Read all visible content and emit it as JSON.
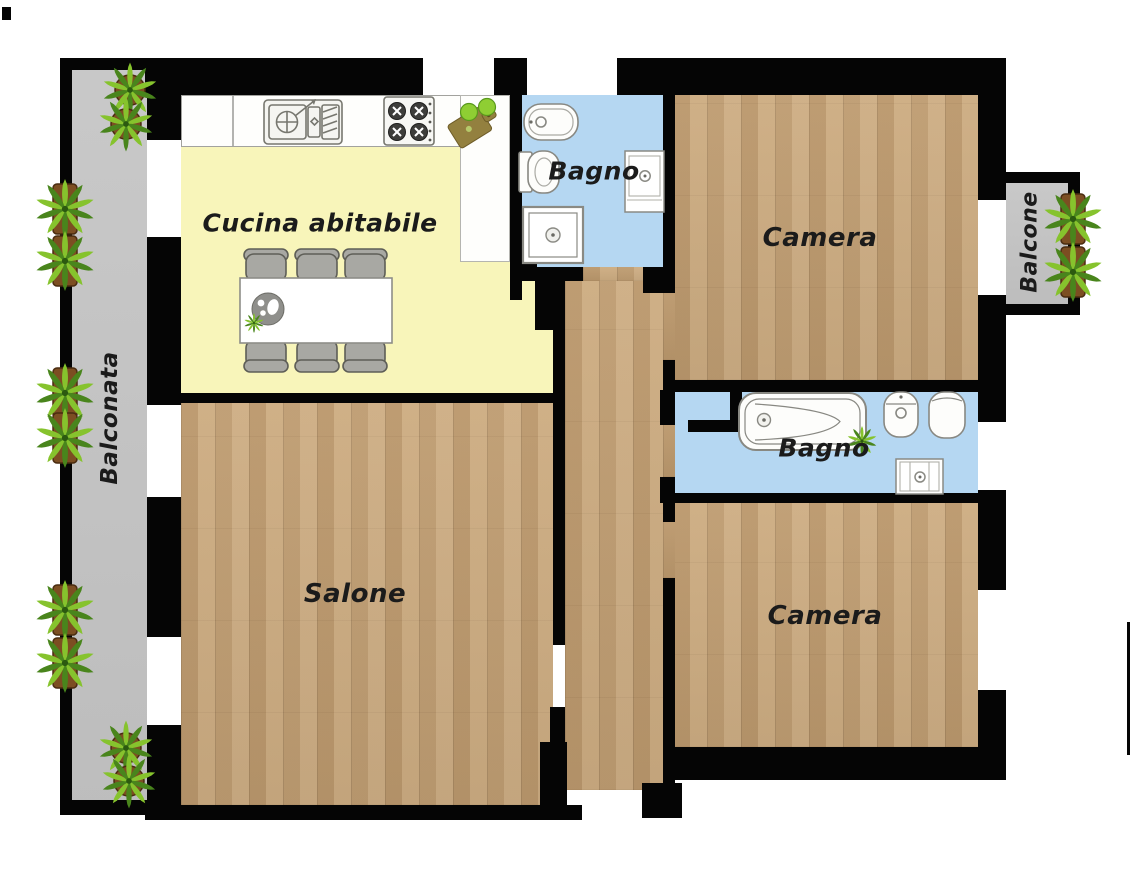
{
  "floorplan": {
    "rooms": {
      "cucina": {
        "label": "Cucina abitabile"
      },
      "bagno_top": {
        "label": "Bagno"
      },
      "camera_top": {
        "label": "Camera"
      },
      "bagno_middle": {
        "label": "Bagno"
      },
      "salone": {
        "label": "Salone"
      },
      "camera_bottom": {
        "label": "Camera"
      },
      "balconata": {
        "label": "Balconata"
      },
      "balcone": {
        "label": "Balcone"
      }
    },
    "colors": {
      "wall": "#050505",
      "wood": "#c9a77b",
      "kitchen": "#f8f5ba",
      "bath": "#b5d7f2",
      "balcony": "#c5c5c5",
      "label": "#1b1b1b",
      "fixture_stroke": "#8a8a86",
      "fixture_fill": "#fdfdfb",
      "chair": "#a8a8a3",
      "chair_stroke": "#5e5e57",
      "plant_green": "#86c32d",
      "plant_green_dark": "#49851c",
      "pot_brown": "#7c4e22",
      "board_olive": "#93803f"
    },
    "fixtures": {
      "kitchen": [
        "sink",
        "cooktop",
        "cutting-board",
        "dining-table",
        "chairs",
        "plate"
      ],
      "bagno_top": [
        "bidet",
        "toilet",
        "shower-tray",
        "washbasin-cabinet"
      ],
      "bagno_middle": [
        "bathtub",
        "bidet",
        "toilet",
        "washbasin-cabinet",
        "plant-sprig"
      ],
      "balconies": [
        "potted-plants",
        "round-plants"
      ]
    }
  }
}
